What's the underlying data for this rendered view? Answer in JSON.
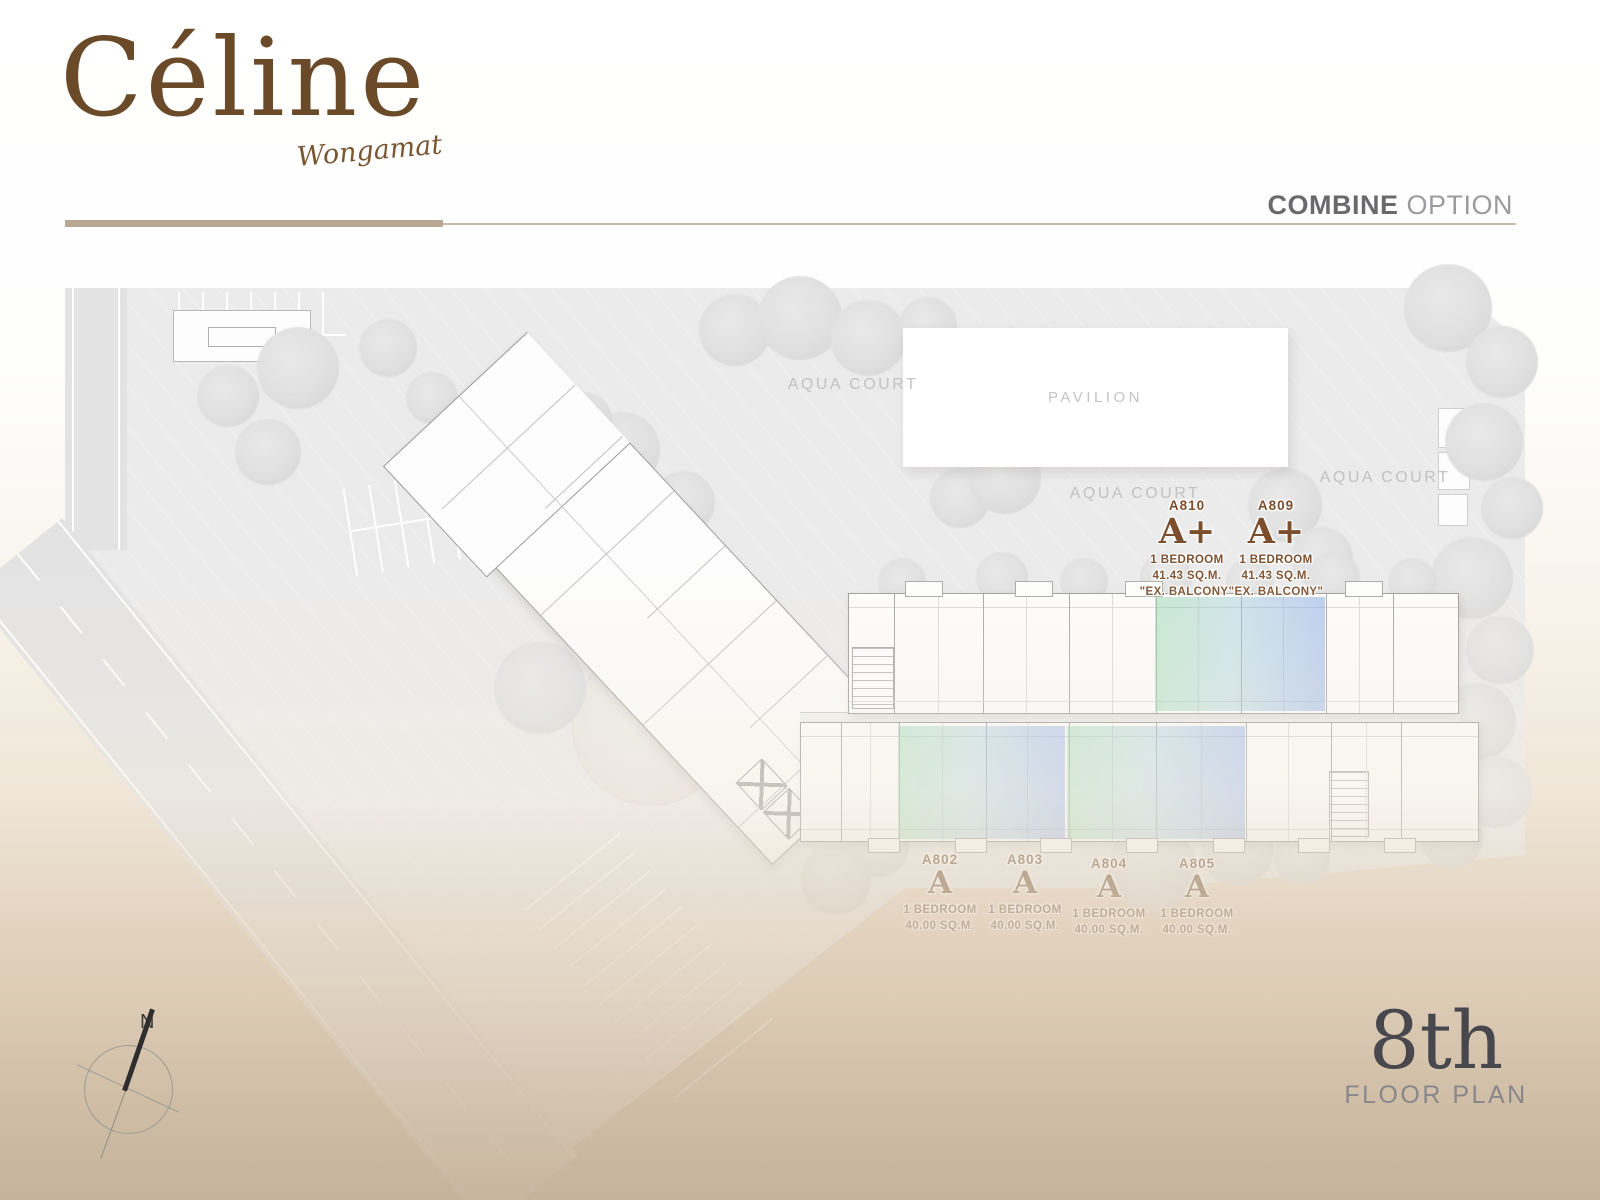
{
  "brand": {
    "name": "Céline",
    "subtitle": "Wongamat"
  },
  "header": {
    "combine": "COMBINE",
    "option": "OPTION"
  },
  "site": {
    "pavilion": "PAVILION",
    "aqua_court_1": "AQUA COURT",
    "aqua_court_2": "AQUA COURT",
    "aqua_court_3": "AQUA COURT"
  },
  "units": {
    "upper": [
      {
        "id": "A810",
        "type": "A+",
        "bedroom": "1 BEDROOM",
        "area": "41.43 SQ.M.",
        "note": "\"EX. BALCONY\""
      },
      {
        "id": "A809",
        "type": "A+",
        "bedroom": "1 BEDROOM",
        "area": "41.43 SQ.M.",
        "note": "\"EX. BALCONY\""
      }
    ],
    "lower": [
      {
        "id": "A802",
        "type": "A",
        "bedroom": "1 BEDROOM",
        "area": "40.00 SQ.M."
      },
      {
        "id": "A803",
        "type": "A",
        "bedroom": "1 BEDROOM",
        "area": "40.00 SQ.M."
      },
      {
        "id": "A804",
        "type": "A",
        "bedroom": "1 BEDROOM",
        "area": "40.00 SQ.M."
      },
      {
        "id": "A805",
        "type": "A",
        "bedroom": "1 BEDROOM",
        "area": "40.00 SQ.M."
      }
    ]
  },
  "floor_badge": {
    "number": "8th",
    "label": "FLOOR PLAN"
  },
  "compass": {
    "north": "N"
  },
  "colors": {
    "brand_brown": "#6a4a28",
    "unit_label_brown": "#7b4f2e",
    "accent_line": "#b7a793",
    "highlight_green": "#8bd2a7",
    "highlight_blue": "#7ca2e4",
    "floor_number_gray": "#47474d"
  }
}
